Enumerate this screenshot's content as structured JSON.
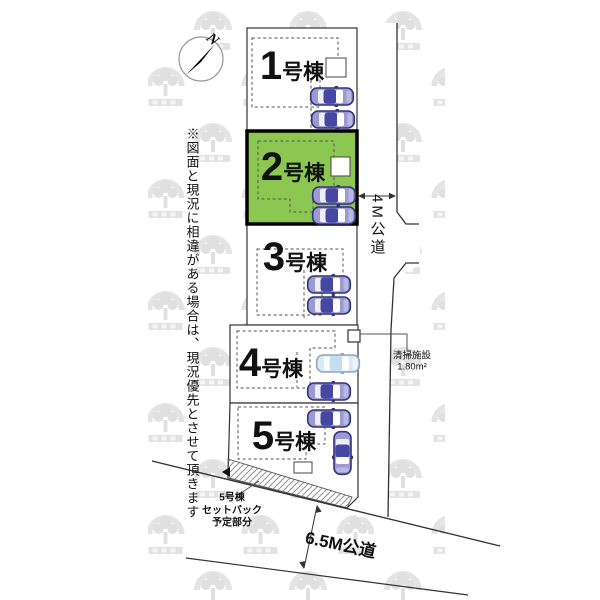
{
  "disclaimer": "※図面と現況に相違がある場合は、現況優先とさせて頂きます",
  "compass": {
    "north_label": "N"
  },
  "lots": [
    {
      "num": "1",
      "suffix": "号棟",
      "highlighted": false
    },
    {
      "num": "2",
      "suffix": "号棟",
      "highlighted": true
    },
    {
      "num": "3",
      "suffix": "号棟",
      "highlighted": false
    },
    {
      "num": "4",
      "suffix": "号棟",
      "highlighted": false
    },
    {
      "num": "5",
      "suffix": "号棟",
      "highlighted": false
    }
  ],
  "roads": {
    "side_road": "4M公道",
    "front_road": "6.5M公道"
  },
  "annotations": {
    "cleaning_facility_name": "清掃施設",
    "cleaning_facility_size": "1.80m²",
    "setback_line1": "5号棟",
    "setback_line2": "セットバック",
    "setback_line3": "予定部分"
  },
  "icons": {
    "watermark": "developer-logo-watermark",
    "compass_needle": "north-arrow",
    "cars": "car-top-view"
  },
  "colors": {
    "highlight_green": "#8CC751",
    "car_purple": "#9B9AD1",
    "car_purple_roof": "#4646A3",
    "car_blue": "#D9EAF5",
    "line_dark": "#333333",
    "watermark_gray": "#E4E4E4"
  }
}
